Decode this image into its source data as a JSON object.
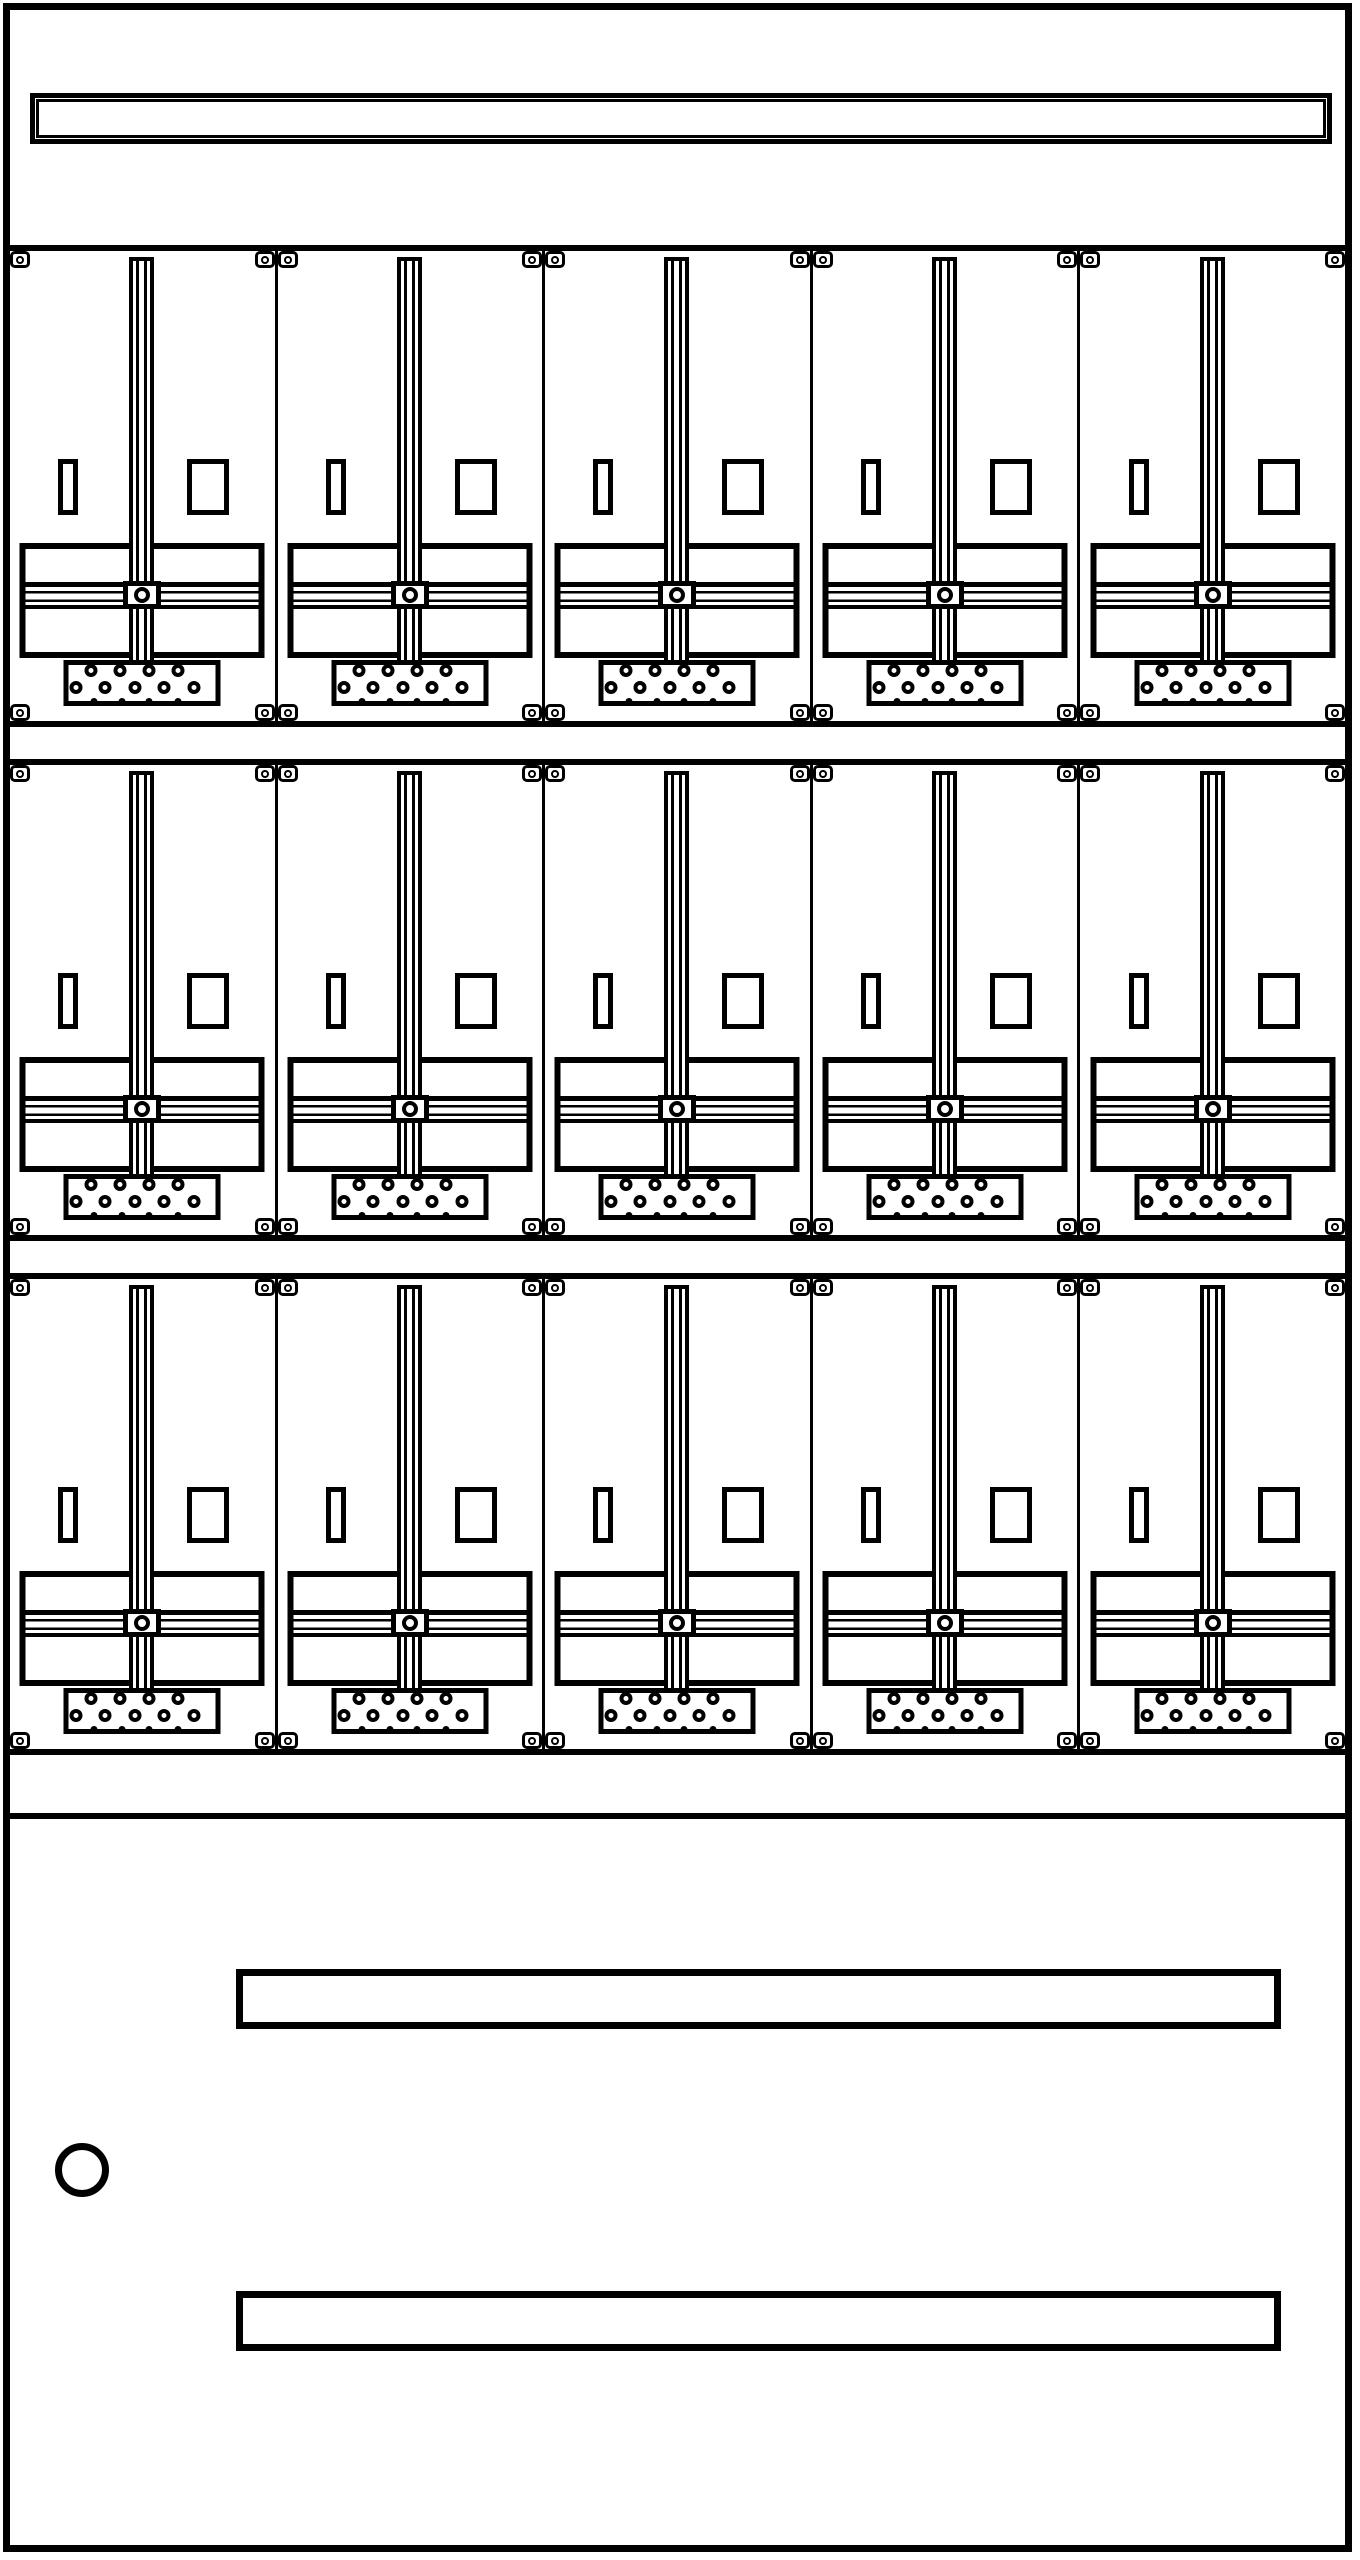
{
  "cabinet": {
    "type": "electrical-meter-cabinet-front-view",
    "background_color": "#ffffff",
    "line_color": "#000000",
    "top_section": {
      "rail_name": "top-busbar-rail"
    },
    "meter_field": {
      "row_count": 3,
      "cells_per_row": 5,
      "cell": {
        "fixing_tab_corners": [
          "top-left",
          "top-right",
          "bottom-left",
          "bottom-right"
        ],
        "components": [
          "vertical-wiring-duct",
          "left-slot",
          "right-slot",
          "mounting-plate",
          "horizontal-rail",
          "center-fixing-screw",
          "terminal-block"
        ],
        "terminal_holes": {
          "rows": [
            {
              "style": "ring",
              "cy": 10,
              "cx": [
                27,
                56,
                85,
                114
              ]
            },
            {
              "style": "ring",
              "cy": 27,
              "cx": [
                12,
                41,
                71,
                100,
                130
              ]
            },
            {
              "style": "dot",
              "cy": 41,
              "cx": [
                30,
                58,
                85,
                114
              ]
            }
          ]
        }
      }
    },
    "door_section": {
      "lock_shape": "circle",
      "slot_count": 2
    }
  }
}
